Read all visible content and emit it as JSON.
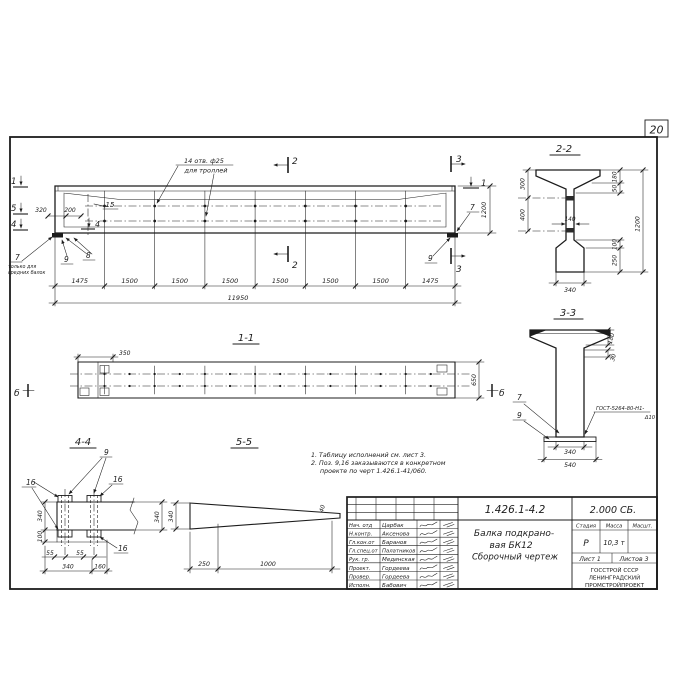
{
  "colors": {
    "ink": "#1c1c1c",
    "paper": "#ffffff"
  },
  "sheet": {
    "page_number": "20"
  },
  "elevation": {
    "holes_note_1": "14 отв. ф25",
    "holes_note_2": "для троллей",
    "mark_1": "1",
    "mark_2": "2",
    "mark_3": "3",
    "mark_4": "4",
    "mark_5": "5",
    "pos_15": "15",
    "pos_7": "7",
    "pos_8": "8",
    "pos_9": "9",
    "pos7_note_1": "только для",
    "pos7_note_2": "средних балок",
    "dim_320": "320",
    "dim_200": "200",
    "dim_row": [
      "1475",
      "1500",
      "1500",
      "1500",
      "1500",
      "1500",
      "1500",
      "1475"
    ],
    "dim_total": "11950",
    "dim_height": "1200"
  },
  "section22": {
    "title": "2-2",
    "dim_300": "300",
    "dim_400": "400",
    "dim_180": "180",
    "dim_50": "50",
    "dim_100": "100",
    "dim_250": "250",
    "dim_1200": "1200",
    "dim_140": "140",
    "dim_340": "340"
  },
  "section33": {
    "title": "3-3",
    "pos_7": "7",
    "pos_9": "9",
    "weld_note_1": "ГОСТ-5264-80-Н1-",
    "weld_note_2": "Δ10",
    "dim_180": "180",
    "dim_30": "30",
    "dim_340": "340",
    "dim_540": "540"
  },
  "section11": {
    "title": "1-1",
    "marker": "б",
    "dim_350": "350",
    "dim_650": "650"
  },
  "section44": {
    "title": "4-4",
    "pos_9": "9",
    "pos_16": "16",
    "dim_340_left": "340",
    "dim_100": "100",
    "dim_340_right": "340",
    "dim_55": "55",
    "dim_340_bottom": "340",
    "dim_160": "160"
  },
  "section55": {
    "title": "5-5",
    "dim_340": "340",
    "dim_40": "40",
    "dim_250": "250",
    "dim_1000": "1000"
  },
  "notes": {
    "line1": "1. Таблицу исполнений см. лист 3.",
    "line2": "2. Поз. 9,16 заказываются в конкретном",
    "line3": "проекте по черт 1.426.1-41/060."
  },
  "title_block": {
    "doc_number": "1.426.1-4.2",
    "doc_code": "2.000 СБ.",
    "title_1": "Балка подкрано-",
    "title_2": "вая БК12",
    "title_3": "Сборочный чертеж",
    "staff": [
      {
        "role": "Нач. отд",
        "name": "Царбак"
      },
      {
        "role": "Н.контр.",
        "name": "Аксенова"
      },
      {
        "role": "Гл.кон.от",
        "name": "Баранов"
      },
      {
        "role": "Гл.спец.от",
        "name": "Палатников"
      },
      {
        "role": "Рук. гр.",
        "name": "Мединская"
      },
      {
        "role": "Проект.",
        "name": "Гордеева"
      },
      {
        "role": "Провер.",
        "name": "Гордеева"
      },
      {
        "role": "Исполн.",
        "name": "Бабович"
      }
    ],
    "stage_header": "Стадия",
    "mass_header": "Масса",
    "scale_header": "Масшт.",
    "stage": "Р",
    "mass": "10,3 т",
    "sheet_no": "Лист 1",
    "sheets_total": "Листов 3",
    "org_1": "ГОССТРОЙ СССР",
    "org_2": "ЛЕНИНГРАДСКИЙ",
    "org_3": "ПРОМСТРОЙПРОЕКТ"
  }
}
